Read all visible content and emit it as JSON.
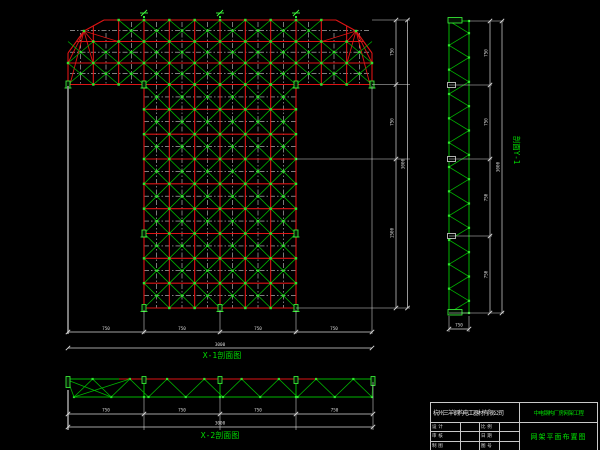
{
  "canvas": {
    "width": 600,
    "height": 450,
    "background": "#000000"
  },
  "colors": {
    "grid_red": "#dd1414",
    "member_green": "#00b400",
    "node_green": "#2ee42e",
    "support_green": "#3cff3c",
    "dim_white": "#d9d9d9",
    "centerline_white": "#cccccc",
    "ext_gray": "#8a8a8a",
    "caption_green": "#00dd00"
  },
  "plan": {
    "caption": "X-1剖面图",
    "bottom_dims": {
      "segments": [
        "750",
        "750",
        "750",
        "750"
      ],
      "total": "3000"
    },
    "right_dims": {
      "segments": [
        "750",
        "750",
        "1500"
      ],
      "total": "3000"
    }
  },
  "side_section": {
    "caption": "剖面Y-1",
    "height_dims": {
      "segments": [
        "750",
        "750",
        "750",
        "750"
      ],
      "total": "3000"
    },
    "width_dim": "750"
  },
  "bottom_section": {
    "caption": "X-2剖面图",
    "bottom_dims": {
      "segments": [
        "750",
        "750",
        "750",
        "750"
      ],
      "total": "3000"
    }
  },
  "title_block": {
    "company": "杭州三羊钢构电工器材有限公司",
    "project": "中电钢构厂房网架工程",
    "drawing_title": "网架平面布置图",
    "rows": [
      {
        "label1": "设 计",
        "value1": "",
        "label2": "比 例",
        "value2": ""
      },
      {
        "label1": "审 核",
        "value1": "",
        "label2": "日 期",
        "value2": ""
      },
      {
        "label1": "制 图",
        "value1": "",
        "label2": "图 号",
        "value2": ""
      }
    ]
  }
}
